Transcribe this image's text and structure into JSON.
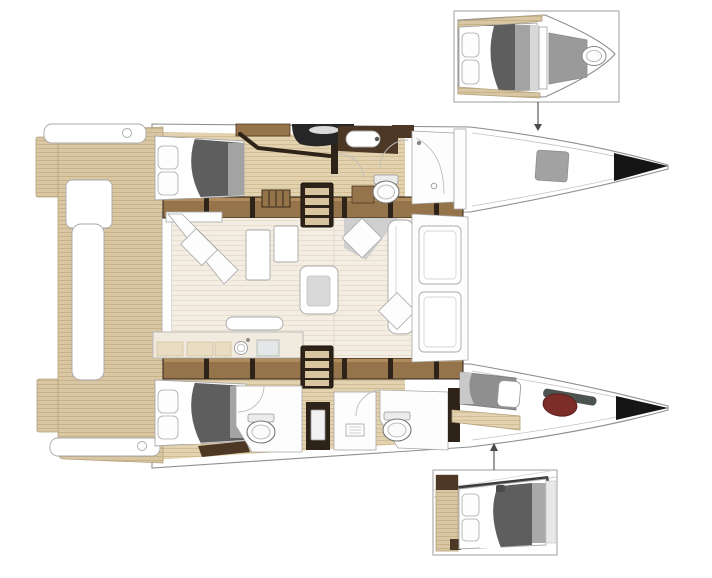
{
  "diagram": {
    "type": "boat-floor-plan",
    "subject": "catamaran-interior-layout-top-view-bow-right",
    "canvas": {
      "width": 712,
      "height": 578
    },
    "boat": {
      "orientation": "bow-right",
      "areas": [
        {
          "name": "aft-cockpit",
          "items": [
            "transom-step-port",
            "transom-step-starboard",
            "teak-deck",
            "transom-bench-port",
            "transom-bench-starboard",
            "cockpit-settee",
            "cockpit-side-bench"
          ]
        },
        {
          "name": "port-hull",
          "items": [
            "aft-double-berth",
            "pillows",
            "overhead-lockers",
            "glazed-hatch",
            "storage-shelf",
            "companionway-steps",
            "washbasin",
            "toilet",
            "shower",
            "door-swing-arcs",
            "bow-hatch"
          ]
        },
        {
          "name": "salon",
          "items": [
            "aft-sliding-door",
            "corner-chaise",
            "storage-cabinets",
            "coffee-table",
            "nav-seat",
            "settee",
            "galley-counter",
            "galley-sink",
            "cooktop",
            "bar-top"
          ]
        },
        {
          "name": "forward-cockpit",
          "items": [
            "forward-bench-hatch-upper",
            "forward-bench-hatch-lower"
          ]
        },
        {
          "name": "starboard-hull",
          "items": [
            "aft-double-berth",
            "pillows",
            "companionway-steps",
            "aft-head-toilet",
            "shower",
            "forward-head-toilet",
            "door-swing-arcs",
            "forward-berth",
            "sail-bag",
            "anchor-gear"
          ]
        },
        {
          "name": "bow",
          "items": [
            "port-bow-tip",
            "starboard-bow-tip"
          ]
        }
      ]
    },
    "insets": [
      {
        "name": "port-bow-cabin-detail",
        "position": "top-right",
        "depicts": [
          "double-berth",
          "pillows",
          "shower-floor",
          "toilet"
        ],
        "connector": "arrow-down-to-port-bow"
      },
      {
        "name": "starboard-bow-cabin-detail",
        "position": "bottom-right",
        "depicts": [
          "double-berth",
          "pillows",
          "wood-lockers"
        ],
        "connector": "arrow-up-to-starboard-bow"
      }
    ]
  },
  "colors": {
    "background": "#ffffff",
    "hull_outline": "#8f8f8f",
    "deck_line": "#c2c2c2",
    "teak_deck": "#d9c6a3",
    "teak_stripe": "#c8b28a",
    "teak_edge": "#b3a07c",
    "interior_floor": "#e3d2b0",
    "interior_stripe": "#d2bd94",
    "salon_floor": "#f3ede3",
    "salon_floor_line": "#e7decd",
    "wood_mid": "#96744b",
    "wood_mid_hi": "#b08c5c",
    "wood_dark": "#4c3824",
    "wood_darkest": "#2e2318",
    "fixture_outline": "#a8a8a8",
    "glass": "#bdbdbd",
    "mattress_dark": "#5e5e5e",
    "mattress_mid": "#a3a3a3",
    "shower_floor": "#9a9a9a",
    "dark_glazing": "#262626",
    "bow_black": "#151515",
    "berth_gray": "#8f8f8f",
    "sail_red": "#7c2d28",
    "gear_gray": "#4d5450",
    "step_tan": "#d8c49e",
    "connector": "#4a4a4a",
    "inset_border": "#9e9e9e"
  }
}
